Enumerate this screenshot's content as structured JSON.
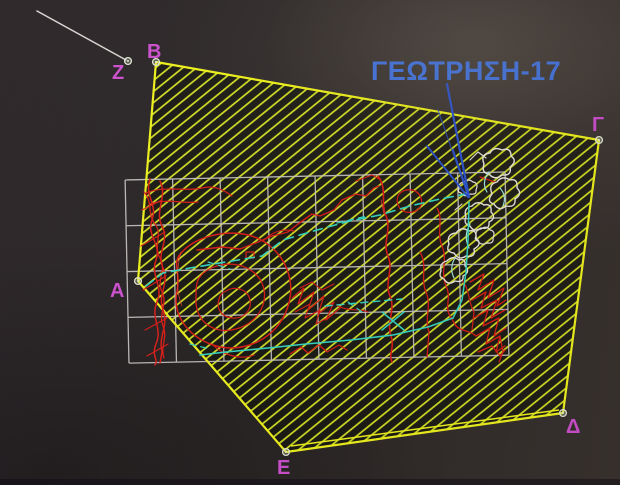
{
  "annotation": {
    "label": "ΓΕΩΤΡΗΣΗ-17",
    "x": 371,
    "y": 80,
    "leaders": [
      [
        447,
        84,
        469,
        197,
        2.2,
        1
      ],
      [
        427,
        146,
        468,
        197,
        1.8,
        1
      ],
      [
        453,
        150,
        469,
        197,
        1.8,
        1
      ],
      [
        438,
        110,
        468,
        196,
        1.2,
        0.75
      ]
    ]
  },
  "leader_line": {
    "x1": 37,
    "y1": 11,
    "x2": 126,
    "y2": 60
  },
  "colors": {
    "background": "#2d2828",
    "hatch": "#d7e51c",
    "boundary": "#f0f313",
    "grid": "#c9c6c3",
    "red": "#e31b15",
    "red2": "#ff4a3a",
    "white": "#eae7e0",
    "cyan": "#2fd9c4",
    "cyanLight": "#9fe8de",
    "leader_blue": "#2c55d4",
    "label_blue": "#3f74e8",
    "vertex_magenta": "#d24ed4",
    "marker": "#e4ead2",
    "leader_white": "#d9d7d2"
  },
  "vertices": [
    {
      "label": "A",
      "x": 138,
      "y": 281,
      "tx": 110,
      "ty": 297
    },
    {
      "label": "B",
      "x": 156,
      "y": 62,
      "tx": 147,
      "ty": 58
    },
    {
      "label": "Γ",
      "x": 599,
      "y": 140,
      "tx": 592,
      "ty": 131
    },
    {
      "label": "Δ",
      "x": 563,
      "y": 413,
      "tx": 566,
      "ty": 433
    },
    {
      "label": "E",
      "x": 286,
      "y": 452,
      "tx": 277,
      "ty": 474
    },
    {
      "label": "Z",
      "x": 128,
      "y": 61,
      "tx": 112,
      "ty": 79
    }
  ],
  "scene": {
    "polygon": {
      "points": "156,62 599,140 563,413 286,452 138,281",
      "fill": "rgba(12,14,2,0.5)"
    },
    "boundary_inner": "M291,446 L559,410",
    "grid": {
      "x": 127,
      "y": 176,
      "cols": 8,
      "rows": 4,
      "cell_w": 47.5,
      "cell_h": 45.8,
      "tilt_deg": -1.2
    },
    "strokes": [
      {
        "n": "contour-braid",
        "c": "red",
        "w": 1.5,
        "d": "M150,179 C144,196 158,204 152,220 C146,236 162,244 156,260 C150,276 164,286 157,302 C150,318 163,328 156,344 C151,356 159,360 155,365"
      },
      {
        "n": "contour-braid",
        "c": "red",
        "w": 1.5,
        "d": "M160,181 C168,198 154,210 162,226 C170,242 156,252 163,268 C170,284 157,294 163,310 C169,326 158,336 162,352 L160,363"
      },
      {
        "n": "contour-braid",
        "c": "red",
        "w": 1.3,
        "d": "M144,192 C153,202 147,214 155,224 C163,234 153,246 160,258 C167,270 156,280 162,292 C168,304 158,314 163,326 C168,338 160,346 164,358"
      },
      {
        "n": "contour-braid-cross",
        "c": "red",
        "w": 1.1,
        "d": "M141,246 L165,232 M143,290 L166,276 M145,330 L167,318 M147,356 L168,344 M142,210 L162,200"
      },
      {
        "n": "contour-loop-outer",
        "c": "red",
        "w": 1.5,
        "d": "M182,252 C198,234 238,226 263,241 C290,258 297,288 285,314 C272,342 239,354 213,345 C187,336 172,314 177,291 C181,271 171,263 182,252 Z"
      },
      {
        "n": "contour-loop-mid",
        "c": "red",
        "w": 1.3,
        "d": "M206,271 C224,259 251,263 261,281 C271,300 259,323 236,329 C213,335 196,321 196,301 C196,286 195,279 206,271 Z"
      },
      {
        "n": "contour-loop-inner",
        "c": "red",
        "w": 1.2,
        "d": "M226,291 C236,285 248,290 250,300 C252,311 243,319 232,318 C221,317 216,308 219,299 C221,293 222,293 226,291 Z"
      },
      {
        "n": "contour-loop-tails",
        "c": "red",
        "w": 1.2,
        "d": "M213,345 C224,356 242,360 254,355 M263,241 C272,232 282,228 294,231"
      },
      {
        "n": "contour-topleft",
        "c": "red",
        "w": 1.2,
        "d": "M146,193 C165,185 185,192 202,188 C214,185 224,190 232,196 M150,204 C168,198 184,204 198,202"
      },
      {
        "n": "contour-long",
        "c": "red",
        "w": 1.4,
        "d": "M197,250 L222,247 L240,249 L258,242 L272,236 L288,232 L298,224 L312,214 L320,216 L334,210 L342,200 L356,194 L366,196 L374,188 L379,186"
      },
      {
        "n": "contour-mid-vertical",
        "c": "red",
        "w": 1.6,
        "d": "M378,176 C388,190 380,202 386,216 C392,230 382,242 388,256 C394,270 384,282 390,296 C396,310 386,322 391,336 C395,348 388,354 392,362"
      },
      {
        "n": "contour-vertical-2",
        "c": "red",
        "w": 1.3,
        "d": "M420,252 C428,266 420,278 426,292 C432,306 424,318 429,332 L427,357"
      },
      {
        "n": "contour-vertical-3",
        "c": "red",
        "w": 1.3,
        "d": "M437,208 C444,220 436,232 442,246 C448,260 440,272 446,286 C452,298 444,306 450,316 L456,326 C462,332 470,330 476,336"
      },
      {
        "n": "contour-small-loop",
        "c": "red",
        "w": 1.2,
        "d": "M399,194 C406,187 418,189 421,198 C424,207 416,214 406,212 C398,210 395,201 399,194 Z"
      },
      {
        "n": "contour-top-bits",
        "c": "red",
        "w": 1.2,
        "d": "M356,181 L372,175 L381,180 M480,177 L495,182"
      },
      {
        "n": "scribble-mid",
        "c": "red",
        "w": 1.2,
        "d": "M292,298 L304,288 L298,304 L314,292 L308,310 L324,296 L318,314 L334,302 L326,320 L340,308"
      },
      {
        "n": "scribble-mid",
        "c": "red",
        "w": 1.1,
        "d": "M295,312 L310,304 L305,318 L320,310 L316,324 L331,316 M300,288 L312,282 L322,290 L334,284"
      },
      {
        "n": "scribble-mid-link",
        "c": "red",
        "w": 1.1,
        "d": "M338,306 C350,312 360,308 368,312"
      },
      {
        "n": "scribble-right",
        "c": "red",
        "w": 1.3,
        "d": "M470,282 L484,274 L478,290 L494,280 L488,298 L504,288 L497,306 L506,300"
      },
      {
        "n": "scribble-right",
        "c": "red",
        "w": 1.3,
        "d": "M472,300 L486,292 L481,308 L497,300 L491,318 L505,310 M474,318 L488,310 L483,326 L499,318 L494,336 L506,328"
      },
      {
        "n": "scribble-right",
        "c": "red",
        "w": 1.3,
        "d": "M476,336 L490,328 L486,344 L500,336 L496,352 L505,346 M478,352 L492,346 L500,356 L505,350"
      },
      {
        "n": "scribble-right-edge",
        "c": "red",
        "w": 1.2,
        "d": "M462,280 C470,290 468,302 474,312 L472,330 M500,336 L503,352 L499,362"
      },
      {
        "n": "scribble-bottom",
        "c": "red",
        "w": 1.2,
        "d": "M290,354 L301,347 L308,353 L319,345 L327,352 L339,345 L347,350"
      },
      {
        "n": "red-tiny-box",
        "c": "red",
        "w": 1.2,
        "d": "M246,252 L254,252 L254,258 L246,258 Z"
      },
      {
        "n": "red-highlight",
        "c": "red2",
        "w": 0.8,
        "o": 0.8,
        "d": "M181,252 C176,270 176,292 182,306 M381,200 L384,214"
      },
      {
        "n": "outcrop-blob",
        "c": "white",
        "w": 1.4,
        "d": "M484,164 Q480,154 490,153 Q494,146 502,150 Q511,147 511,156 Q518,161 510,167 Q512,176 502,175 Q495,181 489,174 Q481,173 484,164 Z"
      },
      {
        "n": "outcrop-blob",
        "c": "white",
        "w": 1.4,
        "d": "M492,194 Q488,184 497,182 Q502,175 510,180 Q518,178 517,188 Q523,194 515,199 Q516,208 506,206 Q499,212 494,204 Q486,202 492,194 Z"
      },
      {
        "n": "outcrop-blob",
        "c": "white",
        "w": 1.4,
        "d": "M466,217 Q463,208 472,206 Q477,200 484,205 Q492,203 491,212 Q497,218 489,222 Q490,230 481,228 Q474,233 470,226 Q463,224 466,217 Z"
      },
      {
        "n": "outcrop-blob",
        "c": "white",
        "w": 1.4,
        "d": "M449,244 Q446,234 456,233 Q461,226 469,231 Q477,229 476,238 Q483,244 474,249 Q476,258 466,256 Q459,261 454,253 Q445,252 449,244 Z"
      },
      {
        "n": "outcrop-blob",
        "c": "white",
        "w": 1.4,
        "d": "M441,271 Q439,263 447,261 Q452,255 459,260 Q466,258 465,266 Q471,272 463,276 Q464,283 455,281 Q448,286 444,279 Q438,277 441,271 Z"
      },
      {
        "n": "outcrop-blob",
        "c": "white",
        "w": 1.2,
        "d": "M476,236 Q475,230 481,229 Q486,225 490,230 Q496,231 493,238 Q494,244 487,243 Q481,246 478,241 Q474,240 476,236 Z"
      },
      {
        "n": "outcrop-blob",
        "c": "white",
        "w": 1.2,
        "d": "M459,189 Q458,183 464,182 Q468,178 473,182 Q479,183 476,190 Q477,195 470,194 Q465,198 461,193 Q457,192 459,189 Z"
      },
      {
        "n": "outcrop-bits",
        "c": "white",
        "w": 1.1,
        "d": "M470,160 L478,152 L486,158 M455,210 L462,204"
      },
      {
        "n": "outcrop-shade",
        "c": "cyanLight",
        "w": 1.2,
        "d": "M489,172 Q481,182 487,192 M500,188 Q507,196 503,206"
      },
      {
        "n": "outcrop-shade",
        "c": "cyanLight",
        "w": 1.2,
        "d": "M470,224 Q463,236 469,248 M455,258 Q449,268 454,278"
      },
      {
        "n": "route-diagonal",
        "c": "cyan",
        "w": 1.6,
        "da": "9,6",
        "d": "M146,286 L163,273 L190,268 L226,262 L262,256 L283,240 L317,230 L350,221 L380,215 L410,206 L440,199 L466,194"
      },
      {
        "n": "route-bottom",
        "c": "cyan",
        "w": 1.6,
        "d": "M200,355 L226,352 L268,348 L306,344 L351,340 L393,335 L428,327 L453,318"
      },
      {
        "n": "route-up-right",
        "c": "cyan",
        "w": 1.5,
        "d": "M453,318 L462,300 L466,272 L468,240 L469,202"
      },
      {
        "n": "route-dashed-h",
        "c": "cyan",
        "w": 1.4,
        "da": "7,5",
        "d": "M325,306 L402,299"
      },
      {
        "n": "route-x-mark",
        "c": "cyan",
        "w": 1.5,
        "d": "M382,312 L404,330 M404,312 L382,330"
      },
      {
        "n": "route-dashes",
        "c": "cyan",
        "w": 1.2,
        "da": "6,5",
        "d": "M337,223 L367,216 M348,302 L362,312 M208,262 L230,269 M190,344 L210,349"
      }
    ]
  }
}
